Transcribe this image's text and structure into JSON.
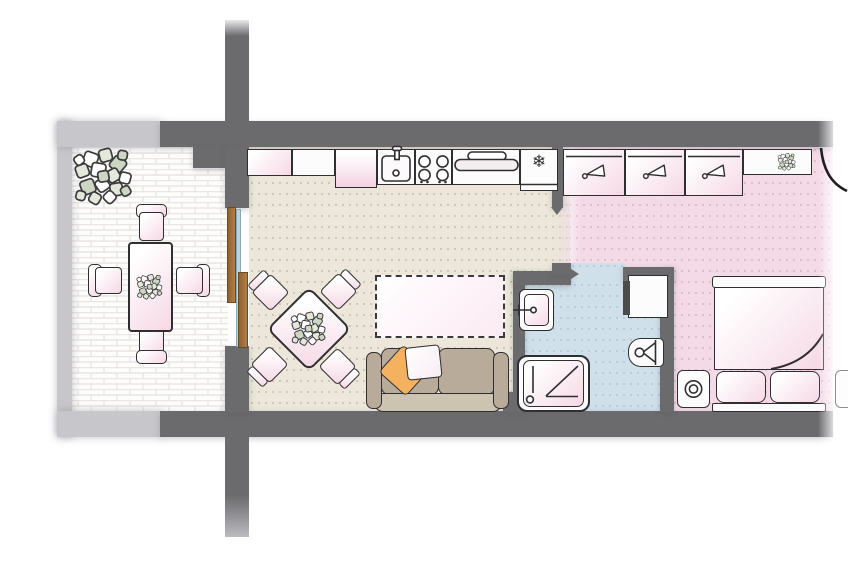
{
  "document": {
    "kind": "apartment floor plan drawing",
    "visible_text": "none"
  },
  "icons": {
    "freezer_snowflake": "❄",
    "hanger-icon": "clothes hanger glyph in each wardrobe unit",
    "plant-icon": "leafy plant cluster"
  },
  "palette": {
    "wall_dark": "#6b6b6e",
    "wall_light": "#c7c7cb",
    "outline": "#2f2f31",
    "floor_living_beige": "#ece7da",
    "floor_bedroom_pink": "#f4dae7",
    "floor_bathroom_blue": "#cfe0ea",
    "floor_patio_white": "#fdfdfc",
    "furniture_pink_gradient": [
      "#ffffff",
      "#f6d8e5"
    ],
    "sofa_taupe": "#b8ab99",
    "pillow_orange": "#f4b15f",
    "door_wood": "#a5773f",
    "glass_blue": "#b9d4e0"
  },
  "scene": {
    "rooms": [
      {
        "name": "patio-terrace",
        "floor": "white brick pavers",
        "items": [
          "large plant",
          "rectangular dining table with centerpiece plant",
          "four chairs"
        ]
      },
      {
        "name": "living-room",
        "floor": "beige dotted",
        "items": [
          "sliding glass door with wood frames",
          "square table rotated 45deg with plant",
          "four corner chairs",
          "dashed rug outline",
          "three-seat sofa with orange and white throw pillows"
        ]
      },
      {
        "name": "kitchen-line",
        "items": [
          "two upper cabinets",
          "counter",
          "sink with faucet",
          "four-burner cooktop",
          "extractor hood",
          "fridge-freezer with snowflake symbol"
        ]
      },
      {
        "name": "bathroom",
        "floor": "light blue dotted",
        "items": [
          "washbasin with faucet",
          "shower tray with drain",
          "toilet",
          "cabinet"
        ]
      },
      {
        "name": "bedroom",
        "floor": "pink dotted",
        "items": [
          "three wardrobe units with hanger symbols",
          "shelf with plant",
          "entry door swing arc",
          "double bed with two pillows and folded blanket",
          "nightstand with round lamp",
          "partial second nightstand at image edge"
        ]
      }
    ]
  }
}
